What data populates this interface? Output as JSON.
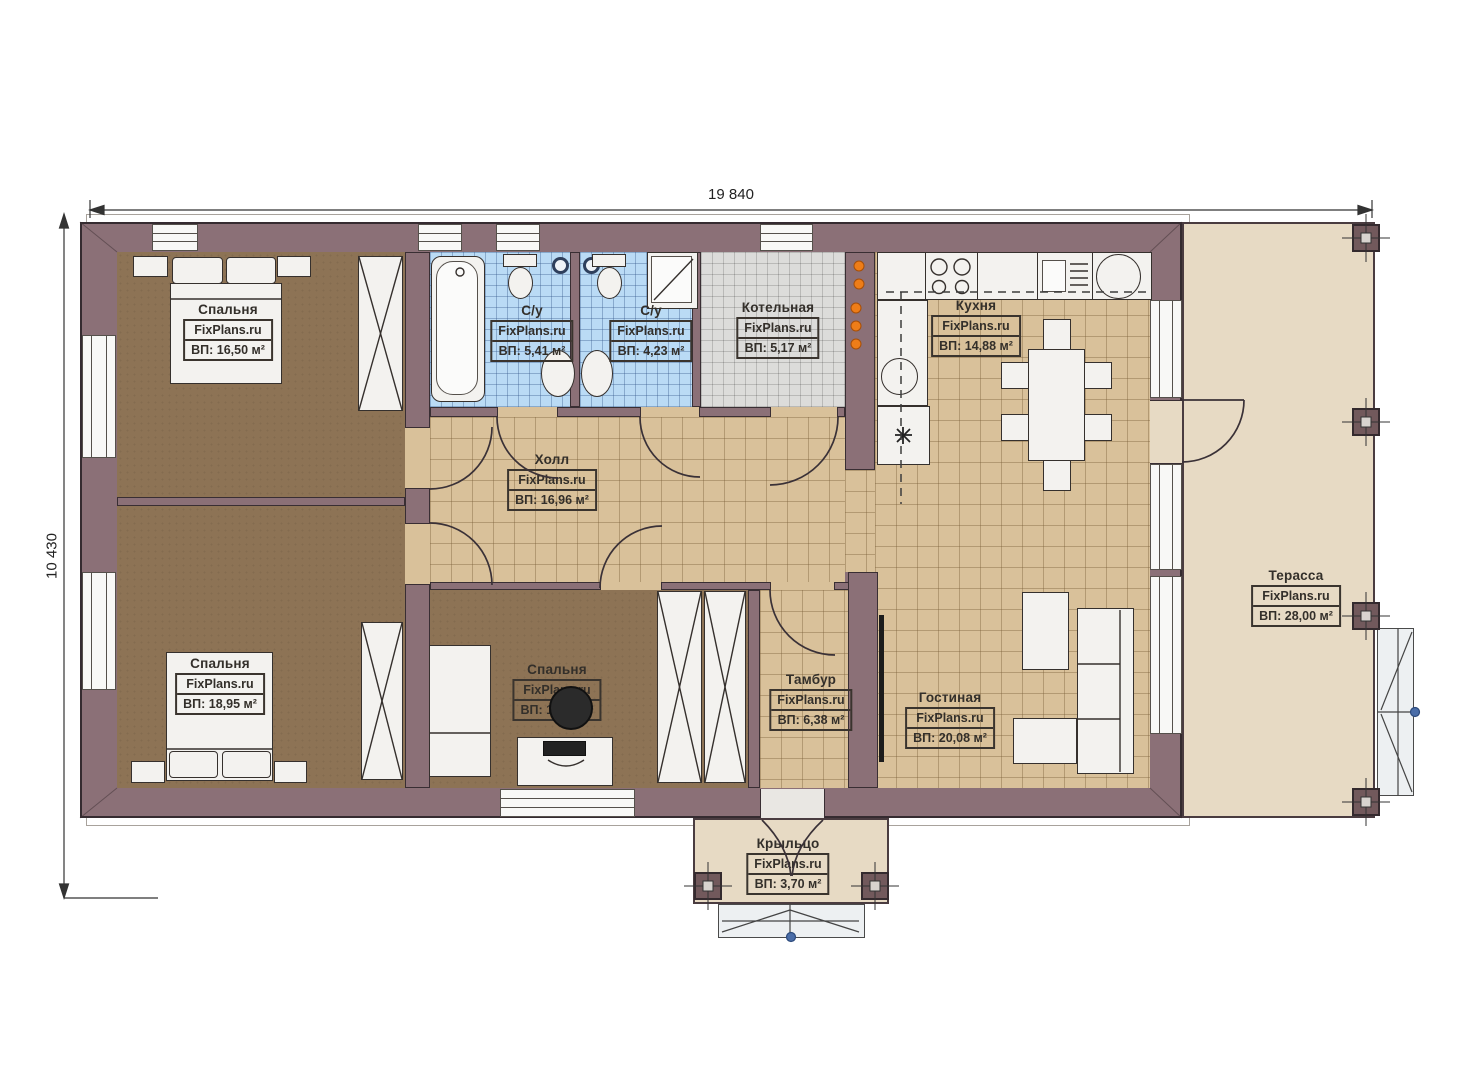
{
  "dimensions": {
    "width": "19 840",
    "height": "10 430"
  },
  "rooms": [
    {
      "id": "bedroom-1",
      "name": "Спальня",
      "brand": "FixPlans.ru",
      "area": "ВП: 16,50 м²"
    },
    {
      "id": "bathroom-1",
      "name": "С/у",
      "brand": "FixPlans.ru",
      "area": "ВП: 5,41 м²"
    },
    {
      "id": "bathroom-2",
      "name": "С/у",
      "brand": "FixPlans.ru",
      "area": "ВП: 4,23 м²"
    },
    {
      "id": "boiler-room",
      "name": "Котельная",
      "brand": "FixPlans.ru",
      "area": "ВП: 5,17 м²"
    },
    {
      "id": "kitchen",
      "name": "Кухня",
      "brand": "FixPlans.ru",
      "area": "ВП: 14,88 м²"
    },
    {
      "id": "hall",
      "name": "Холл",
      "brand": "FixPlans.ru",
      "area": "ВП: 16,96 м²"
    },
    {
      "id": "bedroom-2",
      "name": "Спальня",
      "brand": "FixPlans.ru",
      "area": "ВП: 18,95 м²"
    },
    {
      "id": "bedroom-3",
      "name": "Спальня",
      "brand": "FixPlans.ru",
      "area": "ВП: 11,89 м²"
    },
    {
      "id": "vestibule",
      "name": "Тамбур",
      "brand": "FixPlans.ru",
      "area": "ВП: 6,38 м²"
    },
    {
      "id": "living-room",
      "name": "Гостиная",
      "brand": "FixPlans.ru",
      "area": "ВП: 20,08 м²"
    },
    {
      "id": "terrace",
      "name": "Терасса",
      "brand": "FixPlans.ru",
      "area": "ВП: 28,00 м²"
    },
    {
      "id": "porch",
      "name": "Крыльцо",
      "brand": "FixPlans.ru",
      "area": "ВП: 3,70 м²"
    }
  ],
  "colors": {
    "wall": "#8b7077",
    "bedroom_floor": "#8d7355",
    "tile_floor": "#d9c19a",
    "bathroom_tile": "#badbf5",
    "boiler_tile": "#dcdcda",
    "terrace_floor": "#e7dac4",
    "boiler_indicator_orange": "#ee7d18",
    "marker_blue": "#4a6da8"
  }
}
